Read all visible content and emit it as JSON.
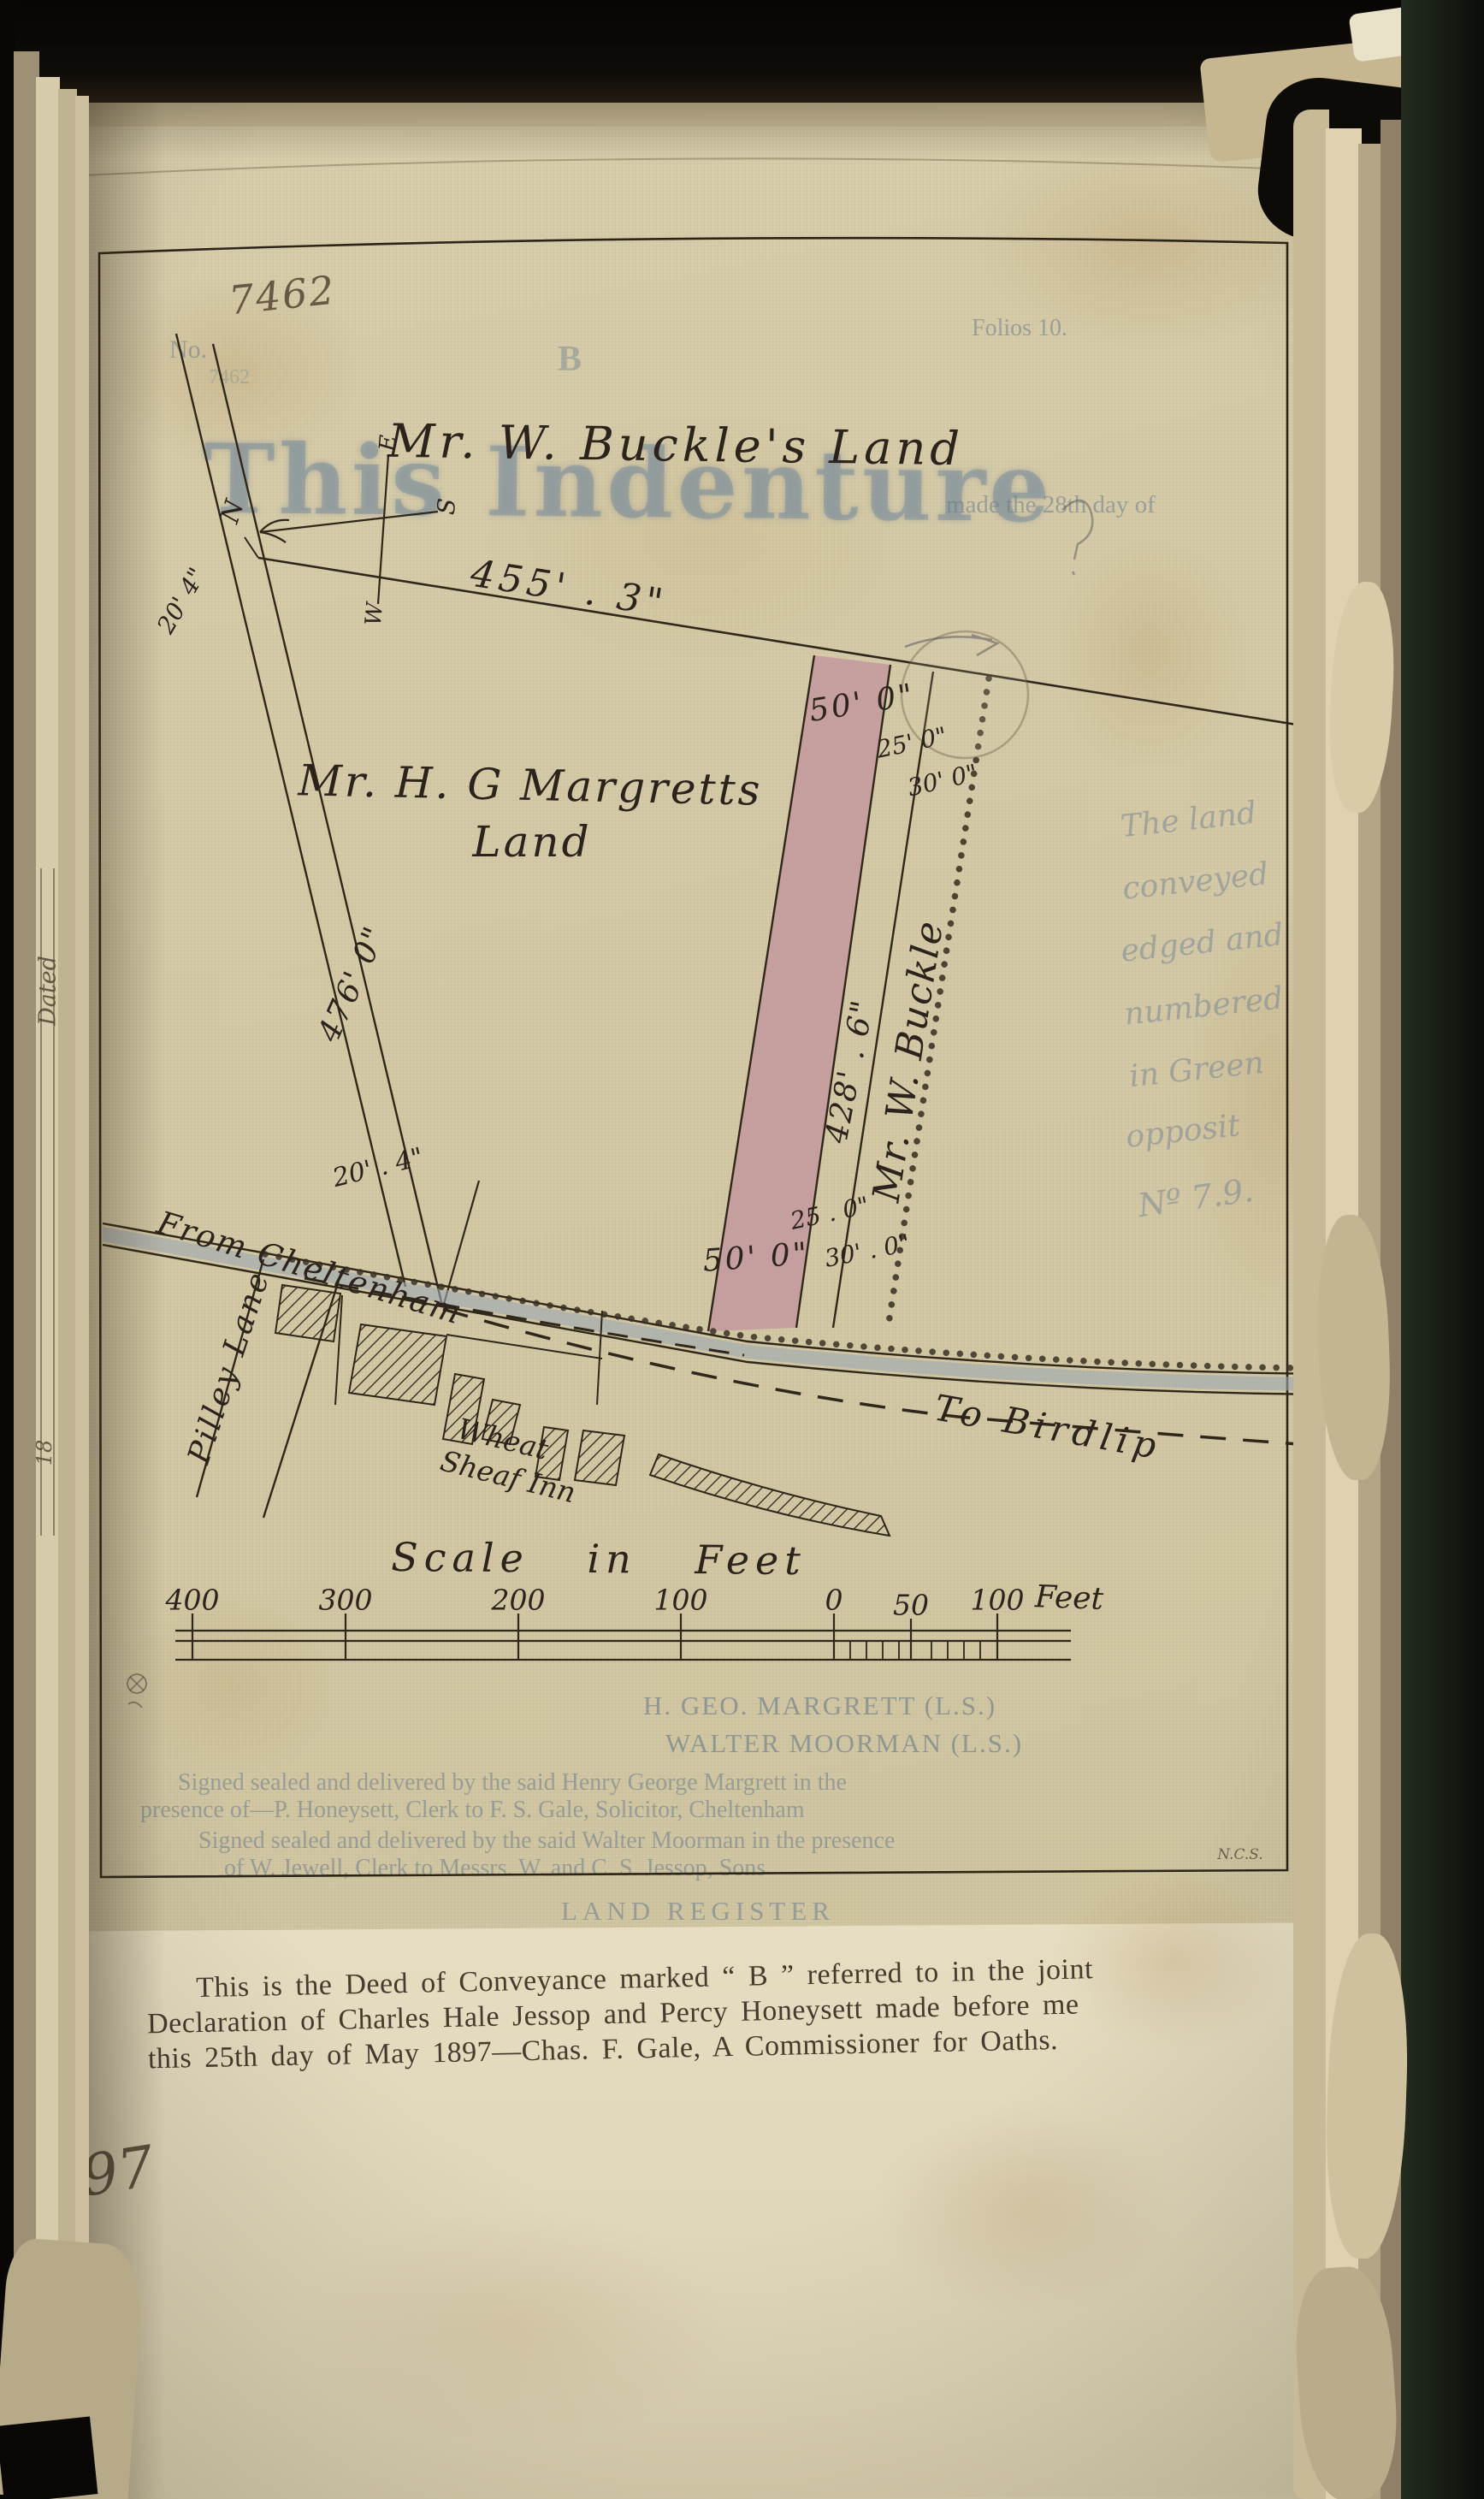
{
  "annotations": {
    "file_number": "7462",
    "page_number": "97",
    "spine_dated": "Dated",
    "spine_year": "18",
    "corner_mark": "N.C.S."
  },
  "margin_note": {
    "lines": [
      "The land",
      "conveyed",
      "edged and",
      "numbered",
      "in Green",
      "opposit",
      "Nº 7.9."
    ]
  },
  "plan": {
    "title": "Mr. W. Buckle's Land",
    "owner_label_line1": "Mr. H. G Margretts",
    "owner_label_line2": "Land",
    "buckle_side_label": "Mr. W. Buckle",
    "compass": {
      "n": "N",
      "s": "S",
      "e": "E",
      "w": "W"
    },
    "measurements": {
      "top_boundary": "455' . 3\"",
      "west_road": "476' 0\"",
      "east_side": "428' . 6\"",
      "offset_top": "20' 4\"",
      "offset_mid": "20' . 4\"",
      "top_50": "50' 0\"",
      "top_25": "25' 0\"",
      "top_30": "30' 0\"",
      "bottom_50": "50' 0\"",
      "bottom_25": "25 . 0\"",
      "bottom_30": "30' . 0\""
    },
    "roads": {
      "from_cheltenham": "From Cheltenham",
      "pilley_lane": "Pilley Lane",
      "to_birdlip": "To Birdlip",
      "inn_line1": "Wheat",
      "inn_line2": "Sheaf Inn"
    },
    "scale": {
      "title": "Scale in Feet",
      "tick_labels": [
        "400",
        "300",
        "200",
        "100",
        "0",
        "50",
        "100"
      ],
      "unit": "Feet"
    }
  },
  "certificate": {
    "line1": "This is the Deed of Conveyance marked “ B ” referred to in the joint",
    "line2": "Declaration of Charles Hale Jessop and Percy Honeysett made before me",
    "line3": "this 25th day of May 1897—Chas. F. Gale, A Commissioner for Oaths."
  },
  "bleedthrough": {
    "header_no": "No.",
    "ghost_number": "7462",
    "mark_b": "B",
    "folios": "Folios 10.",
    "big_title": "This Indenture",
    "made_line": "made the 28th day of",
    "lines": [
      "BETWEEN HENRY GEORGE MARGRETT of Cheltenham in",
      "the County of Gloucester of the one part and WALTER",
      "MOORMAN of the same place Plasterer of the other part WHEREAS the",
      "said Henry George Margrett is seized of the hereditaments and premises",
      "hereinafter described and intended to be hereby conveyed in fee simple in",
      "possession free from incumbrances and he has agreed with the said",
      "Walter Moorman for the absolute sale of the same to him NOW THIS",
      "INDENTURE WITNESSETH that in pursuance of the said agreement and",
      "in consideration of the sum of £100 now paid by the said Walter Moorman",
      "to the said Henry George Margrett the receipt whereof he doth hereby",
      "acknowledge the said Henry George Margrett as Beneficial Owner DOTH",
      "hereby grant and convey unto the said Walter Moorman ALL THAT piece",
      "of land situate on the Old Bath Road at Cheltenham in the County of",
      "Gloucester being part of the Lower Pilford Estate and a portion of the",
      "land comprised in title on the Land Registry and having a frontage to",
      "the said road of fifty feet and extending a uniform depth southward of",
      "fifty feet to the land of Walter Buckle bounded in front or on the",
      "west by the said Bath Road at the back or on the east by the said land",
      "belonging to the said Walter Buckle on the north by other land belonging",
      "to the said Henry Margrett and on the south by a piece of land agreed",
      "to be sold by the said Henry George Margrett to William Moorman the",
      "Younger which piece of land now described is more particularly",
      "delineated in the plan drawn on these presents and colored pink",
      "TO HOLD the same unto and to the use of the said Walter Moorman his",
      "heirs and assigns AND the said Walter hereby covenants with the said",
      "Henry George Margrett to erect and maintain the boundary fence a good",
      "and substantial fence AND the said Henry George Margrett doth hereby",
      "acknowledge the right of the said Walter Moorman to production of the",
      "deeds dated and made between Lord of the first part Lady W of the",
      "second part and Henry George Margrett of the third part which relates",
      "as well to the said hereditaments and premises hereby conveyed as also",
      "to other hereditaments and premises (which still remain vested in the",
      "said Henry George Margrett) and to delivery of copies thereof and",
      "hereby undertakes for the safe custody thereof IN WITNESS whereof",
      "the said parties to these presents have hereunto set their hands and",
      "seals the day and year first before written"
    ],
    "signature1": "H. GEO. MARGRETT  (L.S.)",
    "signature2": "WALTER MOORMAN  (L.S.)",
    "attest1": "Signed sealed and delivered by the said Henry George Margrett in the",
    "attest2": "presence of—P. Honeysett, Clerk to F. S. Gale, Solicitor, Cheltenham",
    "attest3": "Signed sealed and delivered by the said Walter Moorman in the presence",
    "attest4": "of W. Jewell, Clerk to Messrs. W. and C. S. Jessop, Sons",
    "registry": "LAND REGISTER"
  }
}
